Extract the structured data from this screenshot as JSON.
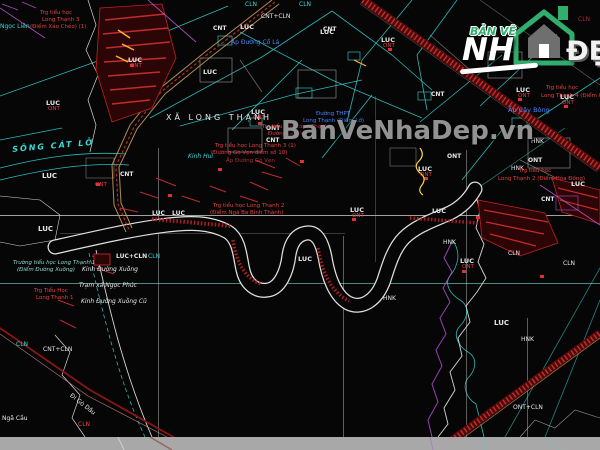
{
  "watermark": {
    "text": "BanVeNhaDep.vn",
    "color": "#9e9e9e"
  },
  "logo": {
    "top_text": "BẢN VẼ",
    "main_text": "NH",
    "suffix_text": "ĐẸP",
    "green": "#2fae6e",
    "house_gray": "#6f6f6f"
  },
  "palette": {
    "background": "#060606",
    "white_line": "#d6d6d6",
    "cyan_line": "#35d8d8",
    "teal_grid": "#6fc9c0",
    "red_bright": "#d23030",
    "red_dark": "#4a0a0a",
    "tan_road": "#c29a5a",
    "magenta": "#c857d8",
    "yellow": "#ffd83a",
    "gray_strip": "#a8a8a8",
    "label_colors": {
      "w": "#e6e6e6",
      "r": "#e64040",
      "dr": "#a83030",
      "c": "#38dcdc",
      "b": "#4a86ff",
      "m": "#d060d0",
      "t": "#8fd8d0",
      "y": "#ffd83a"
    }
  },
  "map": {
    "commune": "XÃ LONG THẠNH",
    "labels": [
      {
        "t": "LUC",
        "x": 46,
        "y": 100,
        "c": "w",
        "s": 6.5,
        "b": true
      },
      {
        "t": "LUC",
        "x": 42,
        "y": 173,
        "c": "w",
        "s": 7,
        "b": true
      },
      {
        "t": "LUC",
        "x": 38,
        "y": 226,
        "c": "w",
        "s": 7,
        "b": true
      },
      {
        "t": "LUC",
        "x": 128,
        "y": 57,
        "c": "w",
        "s": 6.5,
        "b": true
      },
      {
        "t": "LUC",
        "x": 203,
        "y": 69,
        "c": "w",
        "s": 6.5,
        "b": true
      },
      {
        "t": "LUC",
        "x": 240,
        "y": 24,
        "c": "w",
        "s": 6.5,
        "b": true
      },
      {
        "t": "LUC",
        "x": 251,
        "y": 109,
        "c": "w",
        "s": 6.5,
        "b": true
      },
      {
        "t": "LUC",
        "x": 320,
        "y": 29,
        "c": "w",
        "s": 6.5,
        "b": true
      },
      {
        "t": "LUC",
        "x": 381,
        "y": 37,
        "c": "w",
        "s": 6.5,
        "b": true
      },
      {
        "t": "LUC",
        "x": 418,
        "y": 166,
        "c": "w",
        "s": 6.5,
        "b": true
      },
      {
        "t": "LUC",
        "x": 350,
        "y": 207,
        "c": "w",
        "s": 6.5,
        "b": true
      },
      {
        "t": "LUC",
        "x": 432,
        "y": 208,
        "c": "w",
        "s": 6.5,
        "b": true
      },
      {
        "t": "LUC",
        "x": 460,
        "y": 258,
        "c": "w",
        "s": 6.5,
        "b": true
      },
      {
        "t": "LUC",
        "x": 494,
        "y": 320,
        "c": "w",
        "s": 7,
        "b": true
      },
      {
        "t": "LUC",
        "x": 516,
        "y": 87,
        "c": "w",
        "s": 6.5,
        "b": true
      },
      {
        "t": "LUC",
        "x": 560,
        "y": 94,
        "c": "w",
        "s": 6.5,
        "b": true
      },
      {
        "t": "LUC",
        "x": 571,
        "y": 181,
        "c": "w",
        "s": 6.5,
        "b": true
      },
      {
        "t": "LUC",
        "x": 298,
        "y": 256,
        "c": "w",
        "s": 6.5,
        "b": true
      },
      {
        "t": "LUC",
        "x": 152,
        "y": 211,
        "c": "w",
        "s": 6,
        "b": true
      },
      {
        "t": "LUC",
        "x": 172,
        "y": 211,
        "c": "w",
        "s": 6,
        "b": true
      },
      {
        "t": "CNT",
        "x": 120,
        "y": 172,
        "c": "w",
        "s": 6,
        "b": true
      },
      {
        "t": "CNT",
        "x": 213,
        "y": 26,
        "c": "w",
        "s": 6,
        "b": true
      },
      {
        "t": "CNT",
        "x": 323,
        "y": 27,
        "c": "w",
        "s": 6,
        "b": true
      },
      {
        "t": "CNT",
        "x": 431,
        "y": 92,
        "c": "w",
        "s": 6,
        "b": true
      },
      {
        "t": "CNT",
        "x": 541,
        "y": 197,
        "c": "w",
        "s": 6,
        "b": true
      },
      {
        "t": "CNT",
        "x": 266,
        "y": 138,
        "c": "w",
        "s": 6,
        "b": true
      },
      {
        "t": "ONT",
        "x": 266,
        "y": 126,
        "c": "w",
        "s": 6,
        "b": true
      },
      {
        "t": "ONT",
        "x": 447,
        "y": 154,
        "c": "w",
        "s": 6,
        "b": true
      },
      {
        "t": "ONT",
        "x": 528,
        "y": 158,
        "c": "w",
        "s": 6,
        "b": true
      },
      {
        "t": "CLN",
        "x": 245,
        "y": 2,
        "c": "c",
        "s": 6
      },
      {
        "t": "CLN",
        "x": 299,
        "y": 2,
        "c": "c",
        "s": 6
      },
      {
        "t": "CLN",
        "x": 508,
        "y": 251,
        "c": "w",
        "s": 6
      },
      {
        "t": "CLN",
        "x": 563,
        "y": 261,
        "c": "w",
        "s": 6
      },
      {
        "t": "CLN",
        "x": 16,
        "y": 342,
        "c": "c",
        "s": 6
      },
      {
        "t": "CLN",
        "x": 78,
        "y": 422,
        "c": "r",
        "s": 6
      },
      {
        "t": "CLN",
        "x": 578,
        "y": 17,
        "c": "dr",
        "s": 6
      },
      {
        "t": "CLN",
        "x": 148,
        "y": 254,
        "c": "c",
        "s": 6
      },
      {
        "t": "HNK",
        "x": 531,
        "y": 139,
        "c": "w",
        "s": 6
      },
      {
        "t": "HNK",
        "x": 511,
        "y": 166,
        "c": "w",
        "s": 6
      },
      {
        "t": "HNK",
        "x": 521,
        "y": 337,
        "c": "w",
        "s": 6
      },
      {
        "t": "HNK",
        "x": 443,
        "y": 240,
        "c": "w",
        "s": 6
      },
      {
        "t": "HNK",
        "x": 383,
        "y": 296,
        "c": "w",
        "s": 6
      },
      {
        "t": "LUC+CLN",
        "x": 116,
        "y": 254,
        "c": "w",
        "s": 6,
        "b": true
      },
      {
        "t": "CNT+CLN",
        "x": 261,
        "y": 14,
        "c": "w",
        "s": 6
      },
      {
        "t": "CNT+CLN",
        "x": 43,
        "y": 347,
        "c": "w",
        "s": 6
      },
      {
        "t": "ONT+CLN",
        "x": 513,
        "y": 405,
        "c": "w",
        "s": 6
      },
      {
        "t": "ONT",
        "x": 48,
        "y": 107,
        "c": "r",
        "s": 5.5
      },
      {
        "t": "ONT",
        "x": 130,
        "y": 64,
        "c": "r",
        "s": 5.5
      },
      {
        "t": "ONT",
        "x": 253,
        "y": 116,
        "c": "r",
        "s": 5.5
      },
      {
        "t": "ONT",
        "x": 383,
        "y": 44,
        "c": "r",
        "s": 5.5
      },
      {
        "t": "ONT",
        "x": 420,
        "y": 173,
        "c": "r",
        "s": 5.5
      },
      {
        "t": "ONT",
        "x": 352,
        "y": 214,
        "c": "r",
        "s": 5.5
      },
      {
        "t": "ONT",
        "x": 462,
        "y": 265,
        "c": "r",
        "s": 5.5
      },
      {
        "t": "ONT",
        "x": 518,
        "y": 94,
        "c": "r",
        "s": 5.5
      },
      {
        "t": "ONT",
        "x": 562,
        "y": 101,
        "c": "r",
        "s": 5.5
      },
      {
        "t": "ONT",
        "x": 95,
        "y": 183,
        "c": "r",
        "s": 5.5
      },
      {
        "t": "XÃ LONG THẠNH",
        "x": 166,
        "y": 114,
        "c": "w",
        "s": 8,
        "ls": 3
      },
      {
        "t": "SÔNG CÁT LỞ",
        "x": 12,
        "y": 146,
        "c": "c",
        "s": 8,
        "i": true,
        "b": true,
        "ls": 2,
        "r": -5
      },
      {
        "t": "Ngọc Liên",
        "x": 0,
        "y": 24,
        "c": "c",
        "s": 6
      },
      {
        "t": "Ấp Đường Cổ Lá",
        "x": 231,
        "y": 40,
        "c": "b",
        "s": 6
      },
      {
        "t": "Ấp Cây Bông",
        "x": 508,
        "y": 107,
        "c": "b",
        "s": 6.5
      },
      {
        "t": "Đường THPT",
        "x": 316,
        "y": 112,
        "c": "b",
        "s": 5.5
      },
      {
        "t": "Long Thạnh (Điểm Lở)",
        "x": 303,
        "y": 119,
        "c": "b",
        "s": 5.5
      },
      {
        "t": "Trg tiểu học",
        "x": 40,
        "y": 11,
        "c": "r",
        "s": 5.5
      },
      {
        "t": "Long Thạnh 3",
        "x": 42,
        "y": 18,
        "c": "r",
        "s": 5.5
      },
      {
        "t": "(Điểm Xáo Chéo) (1)",
        "x": 30,
        "y": 25,
        "c": "r",
        "s": 5.5
      },
      {
        "t": "Trg tiểu học Long Thạnh 3 (1)",
        "x": 215,
        "y": 144,
        "c": "r",
        "s": 5.5
      },
      {
        "t": "(Đường Gò Vẹn điểm số 10)",
        "x": 211,
        "y": 151,
        "c": "r",
        "s": 5.5
      },
      {
        "t": "Ấp Đường Gò Vẹn",
        "x": 226,
        "y": 159,
        "c": "dr",
        "s": 5.5
      },
      {
        "t": "Trg tiểu học Long Thạnh",
        "x": 262,
        "y": 125,
        "c": "r",
        "s": 5.5
      },
      {
        "t": "Đường Gò Vẹn",
        "x": 268,
        "y": 132,
        "c": "r",
        "s": 5.5
      },
      {
        "t": "Trg tiểu học Long Thạnh 2",
        "x": 213,
        "y": 204,
        "c": "r",
        "s": 5.5
      },
      {
        "t": "(Điểm Ngã Ba Bình Thành)",
        "x": 210,
        "y": 211,
        "c": "r",
        "s": 5.5
      },
      {
        "t": "Trg tiểu học",
        "x": 519,
        "y": 169,
        "c": "r",
        "s": 5.5
      },
      {
        "t": "Long Thạnh 2 (Điểm Hòa Đồng)",
        "x": 498,
        "y": 177,
        "c": "r",
        "s": 5.5
      },
      {
        "t": "Trg tiểu học",
        "x": 546,
        "y": 86,
        "c": "r",
        "s": 5.5
      },
      {
        "t": "Long Thạnh 4 (Điểm Cầu)",
        "x": 541,
        "y": 94,
        "c": "r",
        "s": 5.5
      },
      {
        "t": "Trg Tiểu Học",
        "x": 34,
        "y": 289,
        "c": "r",
        "s": 5.5
      },
      {
        "t": "Long Thạnh 1",
        "x": 36,
        "y": 296,
        "c": "r",
        "s": 5.5
      },
      {
        "t": "Trường tiểu học Long Thạnh 1",
        "x": 13,
        "y": 261,
        "c": "t",
        "s": 5.5,
        "i": true
      },
      {
        "t": "(Điểm Đường Xuồng)",
        "x": 17,
        "y": 268,
        "c": "t",
        "s": 5.5,
        "i": true
      },
      {
        "t": "Kinh Đường Xuồng",
        "x": 82,
        "y": 267,
        "c": "w",
        "s": 6,
        "i": true
      },
      {
        "t": "Trạm xá Ngọc Phúc",
        "x": 79,
        "y": 283,
        "c": "w",
        "s": 6,
        "i": true
      },
      {
        "t": "Kinh Đường Xuồng Cũ",
        "x": 81,
        "y": 299,
        "c": "w",
        "s": 6,
        "i": true
      },
      {
        "t": "Kinh Hui",
        "x": 188,
        "y": 154,
        "c": "c",
        "s": 6,
        "i": true
      },
      {
        "t": "Ngã Cầu",
        "x": 2,
        "y": 416,
        "c": "w",
        "s": 6
      },
      {
        "t": "Đi Gò Dầu",
        "x": 72,
        "y": 393,
        "c": "w",
        "s": 6,
        "r": 38
      }
    ]
  }
}
